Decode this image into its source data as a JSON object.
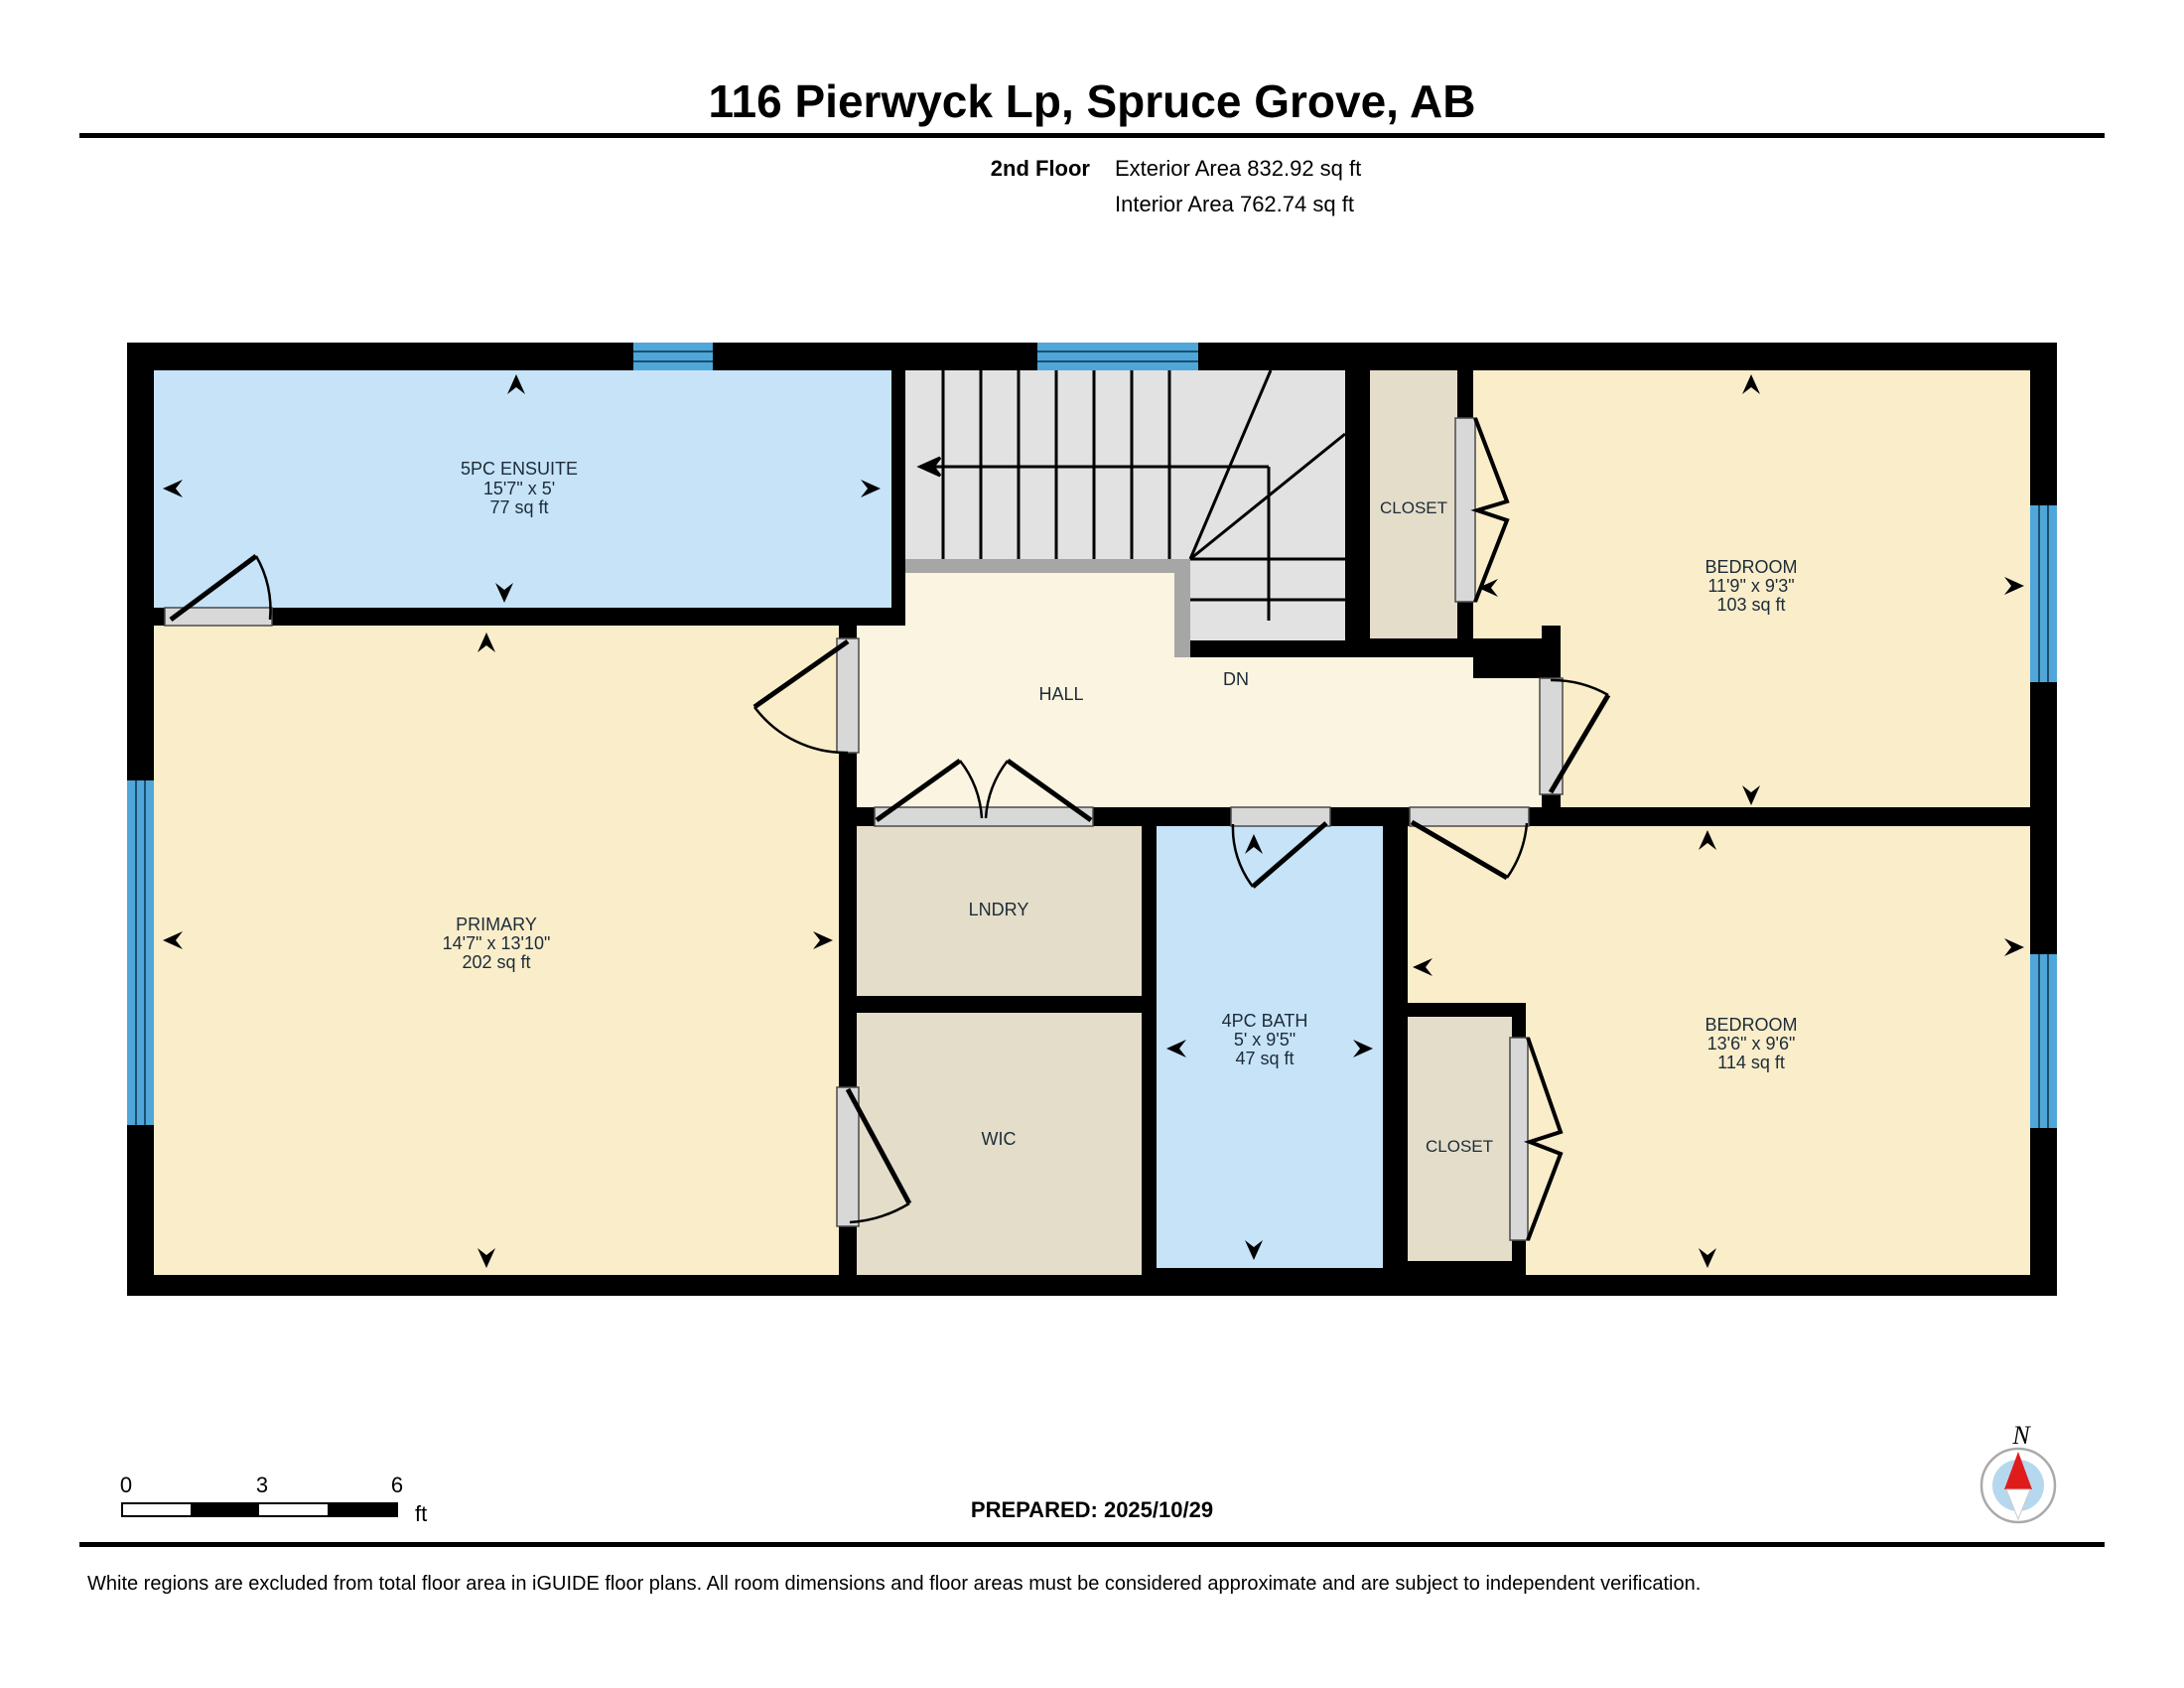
{
  "header": {
    "title": "116 Pierwyck Lp, Spruce Grove, AB",
    "floor_label": "2nd Floor",
    "exterior_area": "Exterior Area 832.92 sq ft",
    "interior_area": "Interior Area 762.74 sq ft"
  },
  "rooms": {
    "ensuite": {
      "name": "5PC ENSUITE",
      "dims": "15'7\" x 5'",
      "area": "77 sq ft"
    },
    "primary": {
      "name": "PRIMARY",
      "dims": "14'7\" x 13'10\"",
      "area": "202 sq ft"
    },
    "bedroom_top": {
      "name": "BEDROOM",
      "dims": "11'9\" x 9'3\"",
      "area": "103 sq ft"
    },
    "bedroom_bottom": {
      "name": "BEDROOM",
      "dims": "13'6\" x 9'6\"",
      "area": "114 sq ft"
    },
    "bath": {
      "name": "4PC BATH",
      "dims": "5' x 9'5\"",
      "area": "47 sq ft"
    },
    "hall": {
      "name": "HALL"
    },
    "laundry": {
      "name": "LNDRY"
    },
    "wic": {
      "name": "WIC"
    },
    "closet_top": {
      "name": "CLOSET"
    },
    "closet_bottom": {
      "name": "CLOSET"
    },
    "stairs": {
      "label": "DN"
    }
  },
  "scale_bar": {
    "tick0": "0",
    "tick1": "3",
    "tick2": "6",
    "unit": "ft"
  },
  "compass": {
    "label": "N"
  },
  "footer": {
    "prepared": "PREPARED: 2025/10/29",
    "disclaimer": "White regions are excluded from total floor area in iGUIDE floor plans. All room dimensions and floor areas must be considered approximate and are subject to independent verification."
  },
  "colors": {
    "room_cream": "#f9edca",
    "hall_cream": "#fbf4e0",
    "storage_tan": "#e4ddc9",
    "wet_room_blue": "#c6e3f8",
    "window_blue": "#4fa6d8",
    "stair_gray": "#e2e2e2",
    "rail_gray": "#a6a6a6",
    "wall_black": "#000000",
    "compass_red": "#e01b1b",
    "compass_inner_blue": "#b5d8ef"
  }
}
